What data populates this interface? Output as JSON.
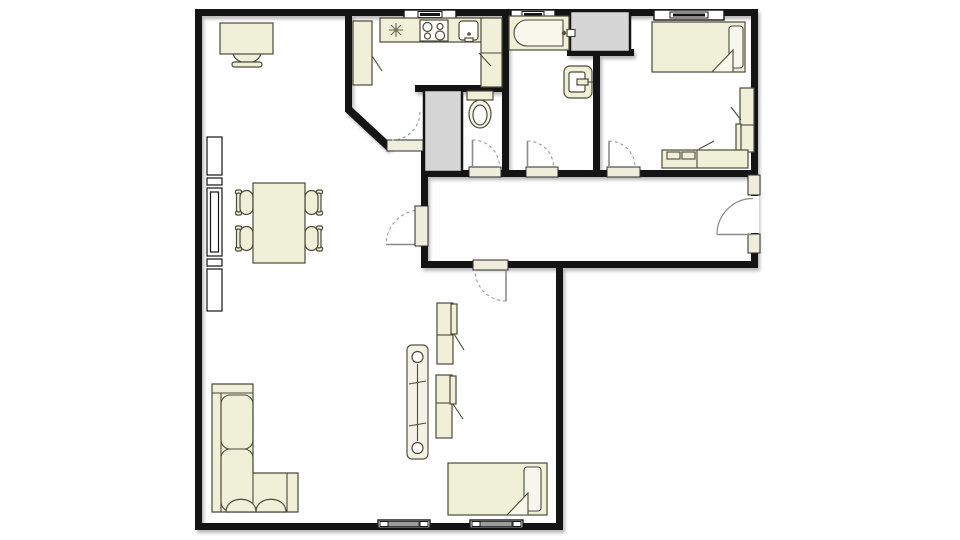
{
  "document": {
    "type": "architectural-floor-plan",
    "visible_text": ""
  },
  "colors": {
    "wall": "#141414",
    "furniture_fill": "#f0efd8",
    "furniture_stroke": "#4a4a3a",
    "shaft_fill": "#d6d6d6",
    "threshold": "#efeedd",
    "window_glass": "#ffffff",
    "swing_arc": "#9a9a9a",
    "open_leaf": "#8a8a8a",
    "vent_fill": "#9c9c9c",
    "floor": "#ffffff"
  },
  "floor_plan": {
    "rooms": [
      {
        "id": "living-room",
        "furniture": [
          "desk",
          "desk-chair",
          "shelving-unit",
          "dining-table",
          "dining-chair",
          "dining-chair",
          "dining-chair",
          "dining-chair",
          "corner-sofa",
          "radiator"
        ],
        "features": [
          "floor-vent",
          "door-to-hallway",
          "door-to-kitchen"
        ]
      },
      {
        "id": "kitchen",
        "furniture": [
          "tall-cabinet",
          "counter",
          "fridge",
          "cooktop",
          "sink",
          "cabinet-column"
        ],
        "features": [
          "window"
        ]
      },
      {
        "id": "wc",
        "furniture": [
          "toilet"
        ],
        "features": [
          "duct-shaft",
          "door-to-hallway"
        ]
      },
      {
        "id": "bathroom",
        "furniture": [
          "bathtub",
          "washbasin"
        ],
        "features": [
          "window",
          "duct-shaft",
          "door-to-hallway"
        ]
      },
      {
        "id": "bedroom-1",
        "furniture": [
          "single-bed",
          "pillow",
          "wardrobe",
          "dresser"
        ],
        "features": [
          "window",
          "door-to-hallway"
        ]
      },
      {
        "id": "bedroom-2",
        "furniture": [
          "single-bed",
          "pillow",
          "wardrobe",
          "wardrobe"
        ],
        "features": [
          "floor-vent",
          "door-to-hallway"
        ]
      },
      {
        "id": "hallway",
        "furniture": [],
        "features": [
          "entrance-door"
        ]
      }
    ]
  }
}
